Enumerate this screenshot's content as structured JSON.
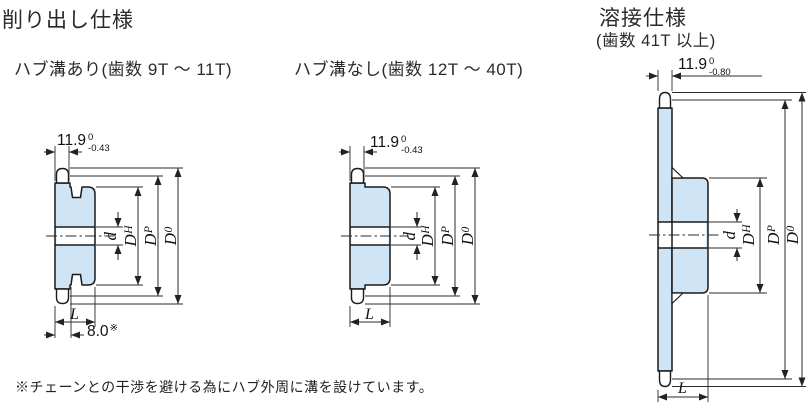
{
  "titles": {
    "machined": "削り出し仕様",
    "welded": "溶接仕様",
    "welded_teeth_range": "(歯数 41T 以上)"
  },
  "captions": {
    "grooved": "ハブ溝あり(歯数 9T 〜 11T)",
    "plain": "ハブ溝なし(歯数 12T 〜 40T)"
  },
  "dimensions": {
    "grooved": {
      "width": "11.9",
      "tol_upper": "0",
      "tol_lower": "-0.43",
      "length": "L",
      "groove": "8.0",
      "groove_mark": "※"
    },
    "plain": {
      "width": "11.9",
      "tol_upper": "0",
      "tol_lower": "-0.43",
      "length": "L"
    },
    "welded": {
      "width": "11.9",
      "tol_upper": "0",
      "tol_lower": "-0.80",
      "length": "L"
    }
  },
  "diameter_labels": {
    "bore": {
      "main": "d",
      "sub": ""
    },
    "hub": {
      "main": "D",
      "sub": "H"
    },
    "pitch": {
      "main": "D",
      "sub": "P"
    },
    "outer": {
      "main": "D",
      "sub": "0"
    }
  },
  "footnote": "※チェーンとの干渉を避ける為にハブ外周に溝を設けています。",
  "colors": {
    "body_fill": "#cfe4f5",
    "line": "#1a1a1a"
  }
}
